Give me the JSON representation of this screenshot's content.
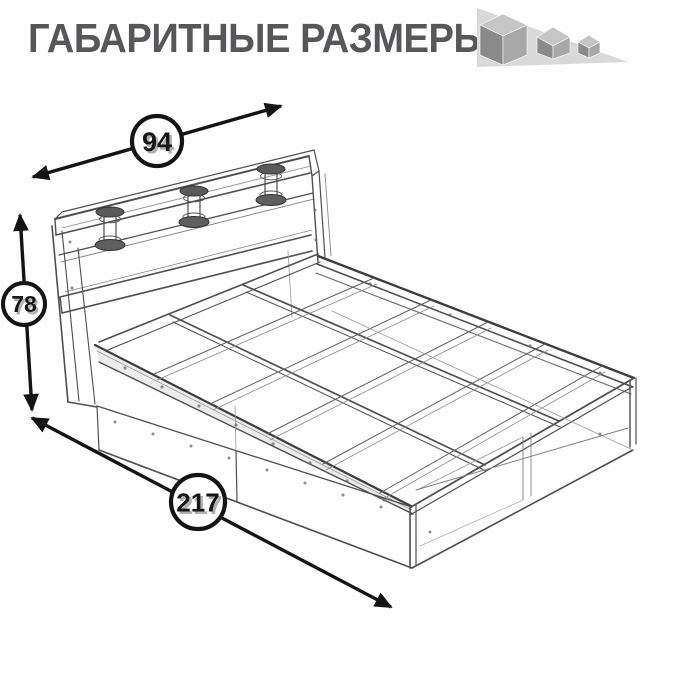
{
  "page": {
    "background": "#fefefe",
    "width": 700,
    "height": 690
  },
  "header": {
    "title": "ГАБАРИТНЫЕ РАЗМЕРЫ",
    "title_color": "#57575a",
    "logo": {
      "icon": "three-shrinking-cubes",
      "triangle_color": "#d9d9d9",
      "cube_top_color": "#c6c6c6",
      "cube_left_color": "#8a8a8a",
      "cube_right_color": "#a8a8a8"
    }
  },
  "drawing": {
    "kind": "wireframe-furniture-sketch",
    "subject": "bed frame with headboard shelf, three spool posts, slatted platform and two underbed drawers",
    "line_color": "#4f4f4f",
    "annotation_color": "#141414",
    "dimensions": [
      {
        "name": "width",
        "value": "94"
      },
      {
        "name": "height",
        "value": "78"
      },
      {
        "name": "length",
        "value": "217"
      }
    ]
  }
}
